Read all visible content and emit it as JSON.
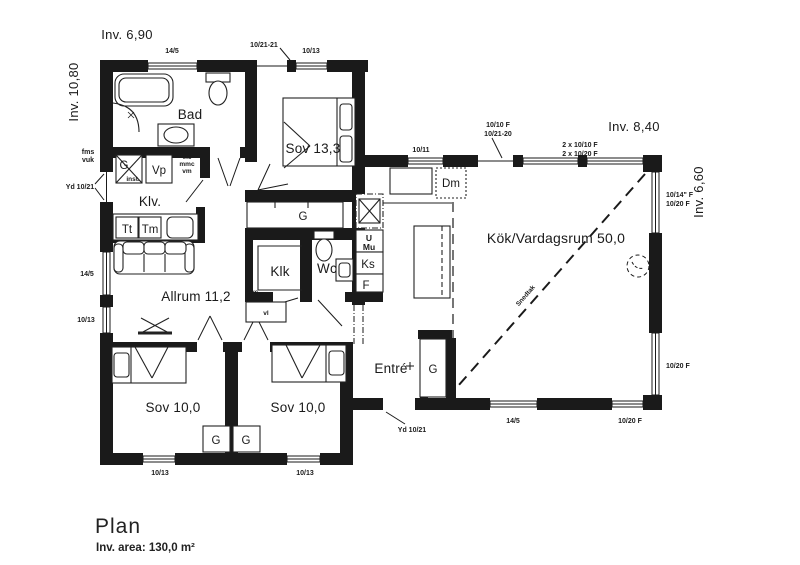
{
  "title": {
    "heading": "Plan",
    "area": "Inv. area: 130,0 m²"
  },
  "dims": {
    "top": "Inv. 6,90",
    "left": "Inv. 10,80",
    "kitchen": "Inv. 8,40",
    "right": "Inv. 6,60"
  },
  "rooms": {
    "bad": "Bad",
    "sov13": "Sov 13,3",
    "klv": "Klv.",
    "allrum": "Allrum 11,2",
    "klk": "Klk",
    "wc": "Wc",
    "sov10a": "Sov 10,0",
    "sov10b": "Sov 10,0",
    "entre": "Entré",
    "kok": "Kök/Vardagsrum 50,0"
  },
  "openings": {
    "top_win1": "14/5",
    "top_door": "10/21-21",
    "top_win2": "10/13",
    "kok_win_top": "10/11",
    "kok_door1": "10/10 F",
    "kok_door2": "10/21-20",
    "kok_win2x_1": "2 x 10/10 F",
    "kok_win2x_2": "2 x 10/20 F",
    "right_win1a": "10/14\" F",
    "right_win1b": "10/20 F",
    "right_win2": "10/20 F",
    "left_door": "Yd 10/21",
    "left_win1": "14/5",
    "left_win2": "10/13",
    "front_door": "Yd 10/21",
    "south_win1": "14/5",
    "south_win2": "10/20 F",
    "south_win_sov_a": "10/13",
    "south_win_sov_b": "10/13"
  },
  "fixtures": {
    "tt": "Tt",
    "tm": "Tm",
    "g_inst": "G",
    "inst": "inst.",
    "vp": "Vp",
    "elc": "elc",
    "mmc": "mmc",
    "vm": "vm",
    "fms": "fms",
    "vuk": "vuk",
    "g_hall": "G",
    "gvc": "gvc",
    "vl": "vl",
    "u": "U",
    "mu": "Mu",
    "ks": "Ks",
    "f": "F",
    "dm": "Dm",
    "g_entre": "G",
    "g_sov_a": "G",
    "g_sov_b": "G",
    "snedtak": "Snedtak"
  }
}
